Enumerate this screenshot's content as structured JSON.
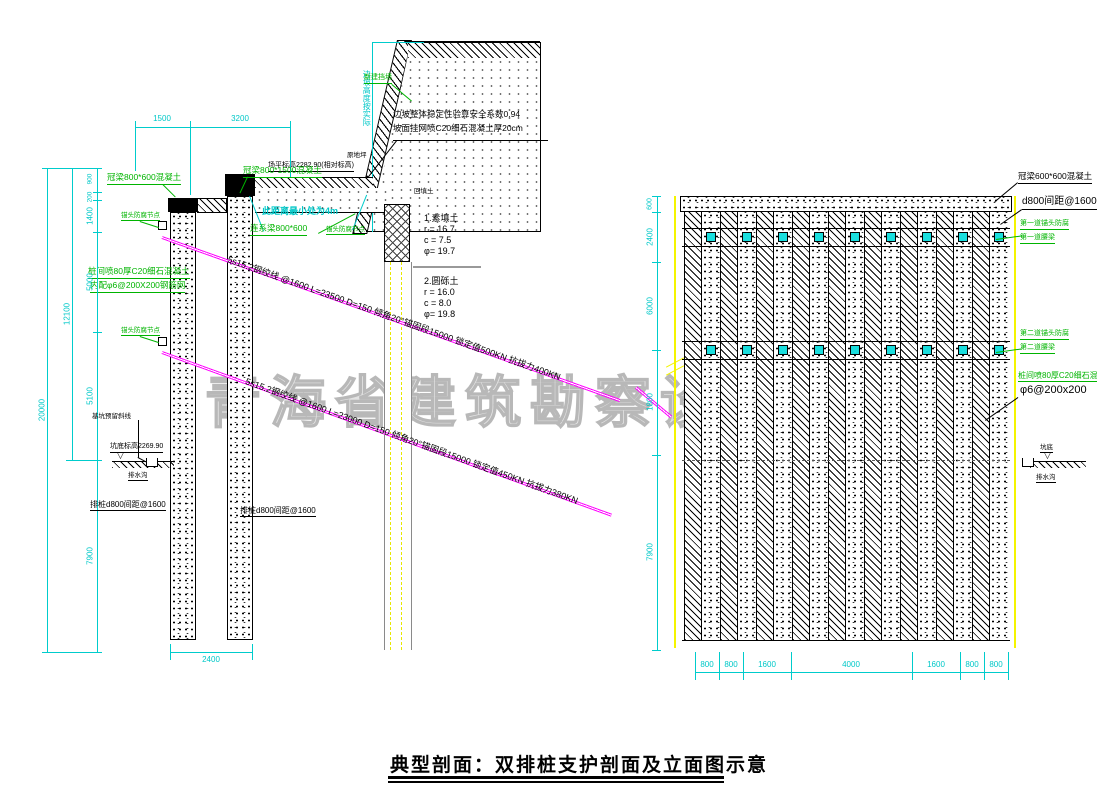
{
  "title": "典型剖面：双排桩支护剖面及立面图示意",
  "watermark": "青海省建筑勘察设计研究院",
  "colors": {
    "cyan": "#00c8c8",
    "green": "#00b400",
    "magenta": "#ff00ff",
    "yellow": "#f4f400"
  },
  "section": {
    "dims": {
      "d1500": "1500",
      "d3200": "3200",
      "d900": "900",
      "d200": "200",
      "d1400": "1400",
      "d5000": "5000",
      "d5100": "5100",
      "d12100": "12100",
      "d7900": "7900",
      "d20000": "20000",
      "d2400": "2400"
    },
    "notes": {
      "stability": "边坡整体稳定性验算安全系数0.94",
      "shotcrete": "坡面挂网喷C20细石混凝土厚20cm",
      "ground": "原地坪",
      "stage2": "二阶段",
      "platform_level": "场平标高2282.90(相对标高)",
      "min_dist": "此距离最小处为4m",
      "new_wall": "新建挡墙",
      "backfill": "回填土",
      "slope_height": "边坡高度按实际",
      "level_mark": "▽"
    },
    "labels": {
      "crown_front": "冠梁800*1500混凝土",
      "crown_rear": "冠梁800*600混凝土",
      "tie_beam": "连系梁800*600",
      "anchor_head_small": "锚头防腐节点",
      "anchor_head_1": "锚头防腐节点",
      "anchor_head_2": "锚头防腐节点",
      "shotcrete_1": "桩间喷80厚C20细石混凝土",
      "shotcrete_2": "内配φ6@200X200钢筋网",
      "reserve_line": "基坑预留斜线",
      "pit_level": "坑底标高2269.90",
      "drain": "排水沟",
      "pile_rear": "排桩d800间距@1600",
      "pile_front": "排桩d800间距@1600"
    },
    "soil1": {
      "name": "1.素填土",
      "r": "r = 16.7",
      "c": "c = 7.5",
      "phi": "φ= 19.7"
    },
    "soil2": {
      "name": "2.圆砾土",
      "r": "r = 16.0",
      "c": "c = 8.0",
      "phi": "φ= 19.8"
    },
    "anchor1": "5s15.2钢绞线 @1600 L=23500 D=150 倾角20°锚固段15000 锁定值500KN 抗拔力400KN",
    "anchor2": "5s15.2钢绞线 @1600 L=23000 D=150 倾角20°锚固段15000 锁定值450KN 抗拔力380KN"
  },
  "elevation": {
    "labels": {
      "crown": "冠梁600*600混凝土",
      "pile": "d800间距@1600",
      "row1_head": "第一道锚头防腐",
      "row1_waler": "第一道腰梁",
      "row2_head": "第二道锚头防腐",
      "row2_waler": "第二道腰梁",
      "shotcrete_1": "桩间喷80厚C20细石混凝土",
      "shotcrete_2": "φ6@200x200",
      "pit": "坑底",
      "drain": "排水沟",
      "level_mark": "▽"
    },
    "left_dims": [
      "600",
      "2400",
      "6000",
      "1800",
      "7900"
    ],
    "bottom_dims": [
      "800",
      "800",
      "1600",
      "4000",
      "1600",
      "800",
      "800"
    ]
  }
}
